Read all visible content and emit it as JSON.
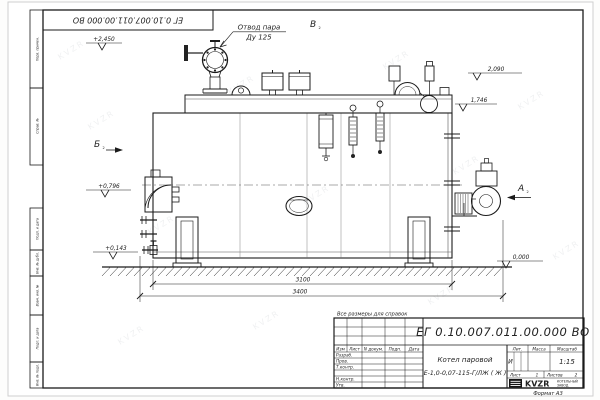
{
  "watermark": {
    "text": "KVZR"
  },
  "top_stamp": {
    "doc_number": "ЕГ 0.10.007.011.00.000  ВО"
  },
  "margin_labels": {
    "perv_primen": "Перв. примен.",
    "sprav_no": "Справ. №",
    "podp_data_1": "Подп. и дата",
    "inv_dubl": "Инв. № дубл.",
    "vzam_inv": "Взам. инв. №",
    "podp_data_2": "Подп. и дата",
    "inv_podl": "Инв. № подл."
  },
  "drawing": {
    "labels": {
      "steam_outlet_1": "Отвод пара",
      "steam_outlet_2": "Ду 125"
    },
    "views": {
      "a": "А",
      "a_sub": "2",
      "b": "Б",
      "b_sub": "2",
      "v": "В",
      "v_sub": "2"
    },
    "levels": {
      "valve_top": "+2,450",
      "rear_top": "2,090",
      "rear_mid": "1,746",
      "front_mid": "+0,796",
      "front_low": "+0,143",
      "ground": "0,000"
    },
    "dimensions": {
      "shell_length": "3100",
      "overall_length": "3400"
    }
  },
  "note": "Все размеры для справок",
  "title_block": {
    "doc_number": "ЕГ 0.10.007.011.00.000  ВО",
    "product_line1": "Котел паровой",
    "product_line2": "Е-1,0-0,07-115-Г/ЛЖ ( Ж )",
    "rev_header": {
      "izm": "Изм",
      "list": "Лист",
      "ndok": "N докум.",
      "podp": "Подп.",
      "data": "Дата"
    },
    "sig_labels": {
      "razrab": "Разраб.",
      "prov": "Пров.",
      "tkontr": "Т.контр.",
      "nkontr": "Н.контр.",
      "utv": "Утв."
    },
    "lit": {
      "label": "Лит.",
      "value": "И"
    },
    "massa": {
      "label": "Масса",
      "value": ""
    },
    "scale": {
      "label": "Масштаб",
      "value": "1:15"
    },
    "sheet": {
      "label": "Лист",
      "value": "1"
    },
    "sheets": {
      "label": "Листов",
      "value": "2"
    },
    "company": {
      "logo": "KVZR",
      "name_1": "КОТЕЛЬНЫЙ",
      "name_2": "ЗАВОД"
    },
    "format": "Формат А3"
  }
}
